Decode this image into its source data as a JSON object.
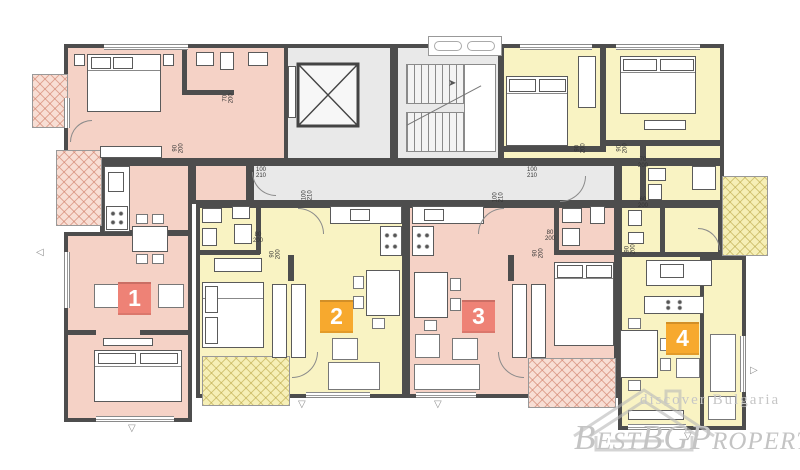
{
  "plan_title": "Residential floor plan with four apartments",
  "apartments": [
    {
      "number": "1",
      "badge_color": "#ee8276",
      "fill": "#f5d2c6"
    },
    {
      "number": "2",
      "badge_color": "#f7a92e",
      "fill": "#f9f3c3"
    },
    {
      "number": "3",
      "badge_color": "#ee8276",
      "fill": "#f5d2c6"
    },
    {
      "number": "4",
      "badge_color": "#f7a92e",
      "fill": "#f9f3c3"
    }
  ],
  "core": {
    "fill": "#e9e9e9",
    "wall_color": "#4d4d4d"
  },
  "dimension_labels": [
    {
      "text": "70\n200",
      "x": 224,
      "y": 92,
      "rot": 90
    },
    {
      "text": "90\n200",
      "x": 174,
      "y": 142,
      "rot": 90
    },
    {
      "text": "100\n210",
      "x": 256,
      "y": 167,
      "rot": 0
    },
    {
      "text": "100\n210",
      "x": 303,
      "y": 189,
      "rot": 90
    },
    {
      "text": "80\n200",
      "x": 253,
      "y": 232,
      "rot": 0
    },
    {
      "text": "90\n200",
      "x": 271,
      "y": 248,
      "rot": 90
    },
    {
      "text": "80\n200",
      "x": 545,
      "y": 230,
      "rot": 0
    },
    {
      "text": "90\n200",
      "x": 534,
      "y": 247,
      "rot": 90
    },
    {
      "text": "100\n210",
      "x": 527,
      "y": 167,
      "rot": 0
    },
    {
      "text": "100\n210",
      "x": 494,
      "y": 191,
      "rot": 90
    },
    {
      "text": "90\n200",
      "x": 576,
      "y": 142,
      "rot": 90
    },
    {
      "text": "90\n200",
      "x": 618,
      "y": 142,
      "rot": 90
    },
    {
      "text": "70\n200",
      "x": 638,
      "y": 157,
      "rot": 0
    },
    {
      "text": "60\n200",
      "x": 638,
      "y": 197,
      "rot": 0
    },
    {
      "text": "90\n200",
      "x": 626,
      "y": 243,
      "rot": 90
    }
  ],
  "watermark": {
    "tagline": "discover Bulgaria",
    "brand": "BestBGProperties"
  }
}
